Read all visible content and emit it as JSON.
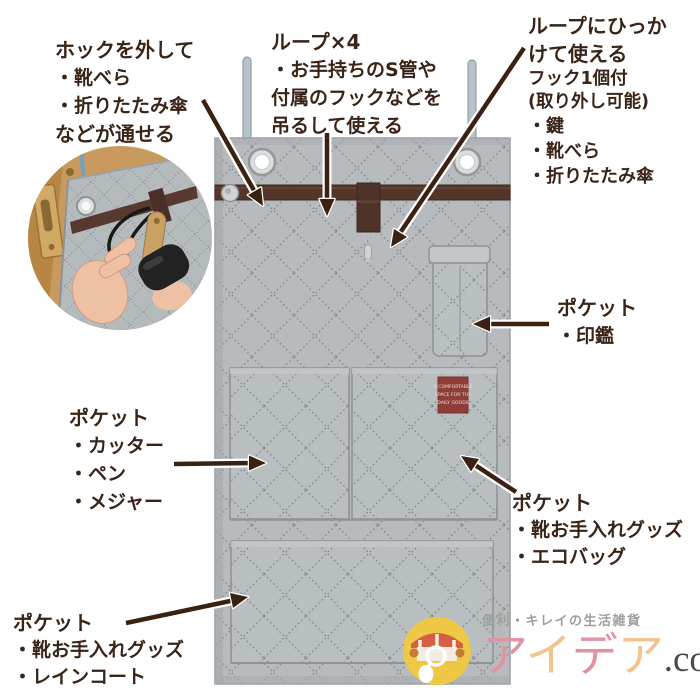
{
  "annotations": {
    "hock": {
      "lines": [
        "ホックを外して",
        "・靴べら",
        "・折りたたみ傘",
        "などが通せる"
      ]
    },
    "loop4": {
      "lines": [
        "ループ×4",
        "・お手持ちのS管や",
        "付属のフックなどを",
        "吊るして使える"
      ]
    },
    "hook1": {
      "lines": [
        "ループにひっか",
        "けて使える",
        "フック1個付",
        "(取り外し可能)",
        "・鍵",
        "・靴べら",
        "・折りたたみ傘"
      ]
    },
    "pocket_seal": {
      "lines": [
        "ポケット",
        "・印鑑"
      ]
    },
    "pocket_tools": {
      "lines": [
        "ポケット",
        "・カッター",
        "・ペン",
        "・メジャー"
      ]
    },
    "pocket_eco": {
      "lines": [
        "ポケット",
        "・靴お手入れグッズ",
        "・エコバッグ"
      ]
    },
    "pocket_rain": {
      "lines": [
        "ポケット",
        "・靴お手入れグッズ",
        "・レインコート"
      ]
    }
  },
  "product_label": {
    "lines": [
      "A COMFORTABLE",
      "SPACE FOR THE",
      "DAILY GOODS"
    ]
  },
  "logo": {
    "tagline": "便利・キレイの生活雑貨",
    "brand_1": "ア",
    "brand_2": "イ",
    "brand_3": "デ",
    "brand_4": "ア",
    "suffix": ".com"
  },
  "colors": {
    "annotation_text": "#3a2418",
    "arrow": "#3b2112",
    "fabric": "#b7bbbe",
    "fabric_stitch": "#84888b",
    "strap_brown": "#543529",
    "label_maroon": "#8e3e37",
    "door_hook_blue": "#b6c3c9",
    "logo_yellow": "#f1c93e",
    "brand_pink": "#e2939f",
    "brand_orange": "#f2c38a",
    "tagline_gray": "#a09d9a"
  }
}
